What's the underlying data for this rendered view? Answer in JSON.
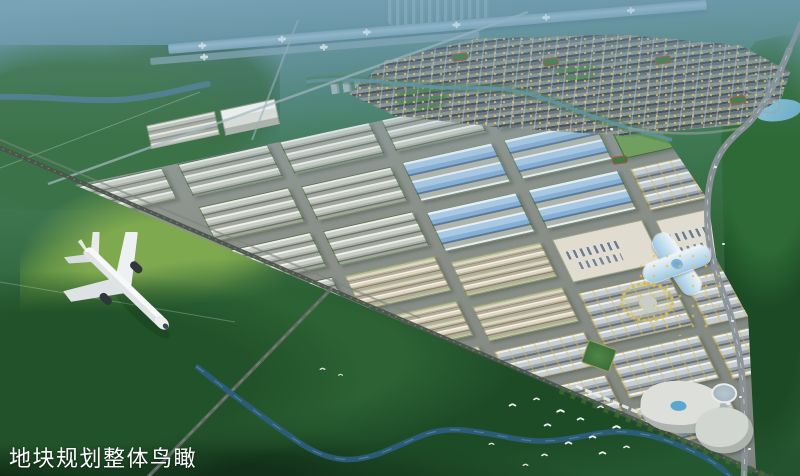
{
  "caption": {
    "text": "地块规划整体鸟瞰"
  },
  "scene": {
    "title": "Industrial park master plan — overall aerial rendering",
    "palette": {
      "haze": "#7aa3b4",
      "forest_dark": "#1d4a26",
      "forest_mid": "#2d6434",
      "meadow": "#7fa94f",
      "runway": "#8fb4c6",
      "warehouse_roof": "#c9cdc5",
      "blue_roof": "#a8c8e3",
      "beige_block": "#ddd7c4",
      "civic_block": "#c6ced4",
      "plaza": "#e0ddd0",
      "road": "#8a9298",
      "river": "#2e5d7e",
      "rail": "#4a544b",
      "landmark_glass": "#9cc8e4",
      "gold_tree": "#dabb49",
      "caption_color": "#ffffff"
    },
    "park": {
      "blocks": [
        [
          0,
          2,
          88,
          36,
          "gray"
        ],
        [
          104,
          2,
          92,
          38,
          "gray"
        ],
        [
          104,
          52,
          92,
          40,
          "gray"
        ],
        [
          104,
          104,
          92,
          40,
          "gray"
        ],
        [
          104,
          156,
          92,
          38,
          "gray"
        ],
        [
          208,
          2,
          92,
          38,
          "gray"
        ],
        [
          208,
          54,
          92,
          40,
          "gray"
        ],
        [
          208,
          106,
          92,
          40,
          "gray"
        ],
        [
          208,
          158,
          92,
          40,
          "beige"
        ],
        [
          208,
          210,
          92,
          40,
          "beige"
        ],
        [
          208,
          262,
          92,
          38,
          "beige"
        ],
        [
          312,
          2,
          92,
          38,
          "gray"
        ],
        [
          312,
          52,
          92,
          46,
          "blue"
        ],
        [
          312,
          110,
          92,
          46,
          "blue"
        ],
        [
          312,
          168,
          92,
          40,
          "beige"
        ],
        [
          312,
          220,
          92,
          40,
          "beige"
        ],
        [
          312,
          272,
          92,
          38,
          "civic"
        ],
        [
          312,
          322,
          92,
          42,
          "civic"
        ],
        [
          416,
          2,
          92,
          38,
          "blue"
        ],
        [
          416,
          52,
          92,
          46,
          "blue"
        ],
        [
          416,
          110,
          92,
          46,
          "blue"
        ],
        [
          416,
          168,
          92,
          50,
          "plaza"
        ],
        [
          416,
          230,
          92,
          60,
          "civic"
        ],
        [
          416,
          302,
          92,
          50,
          "civic"
        ],
        [
          416,
          364,
          92,
          46,
          "civic"
        ],
        [
          520,
          28,
          64,
          72,
          "green"
        ],
        [
          520,
          112,
          64,
          48,
          "civic"
        ],
        [
          520,
          172,
          64,
          56,
          "plaza"
        ],
        [
          520,
          240,
          64,
          54,
          "civic"
        ],
        [
          520,
          306,
          64,
          50,
          "civic"
        ]
      ]
    },
    "runway": {
      "jets_main": [
        30,
        110,
        195,
        285,
        375,
        460
      ],
      "jets_apron": [
        50,
        170
      ]
    },
    "birds": [
      [
        318,
        366,
        0.7
      ],
      [
        336,
        372,
        0.6
      ],
      [
        508,
        402,
        0.9
      ],
      [
        532,
        396,
        0.8
      ],
      [
        556,
        408,
        1
      ],
      [
        543,
        422,
        0.9
      ],
      [
        576,
        416,
        0.9
      ],
      [
        596,
        404,
        0.8
      ],
      [
        612,
        424,
        1
      ],
      [
        588,
        434,
        0.9
      ],
      [
        564,
        440,
        0.9
      ],
      [
        540,
        452,
        0.8
      ],
      [
        598,
        450,
        0.9
      ],
      [
        622,
        444,
        0.8
      ],
      [
        521,
        462,
        0.7
      ],
      [
        487,
        441,
        0.7
      ]
    ],
    "fields": [
      [
        452,
        53
      ],
      [
        543,
        58
      ],
      [
        655,
        56
      ],
      [
        730,
        96
      ],
      [
        612,
        156
      ]
    ],
    "cars": [
      [
        714,
        166
      ],
      [
        722,
        243
      ],
      [
        731,
        320
      ],
      [
        739,
        396
      ],
      [
        748,
        448
      ],
      [
        610,
        128
      ]
    ],
    "green_squares": [
      [
        584,
        344,
        30,
        24,
        20
      ]
    ]
  }
}
